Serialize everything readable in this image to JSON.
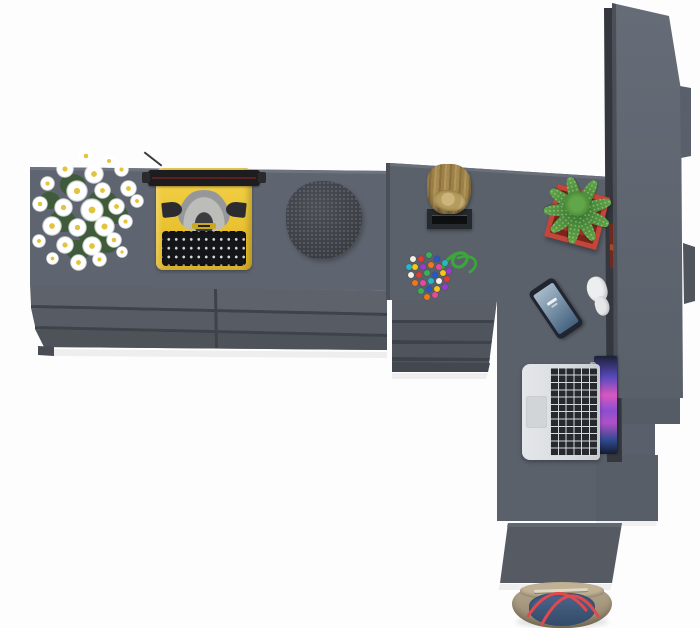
{
  "scene": {
    "type": "3d-render-top-view",
    "label": "Top-down view of a dark gray L-shaped desk with shelf unit and accessories on a white floor"
  },
  "palette": {
    "floor": "#fdfdfd",
    "desk_top": "#5f6570",
    "desk_top_edge": "#6e747f",
    "desk_surface": "#5a616b",
    "surface_edge": "#6a707b",
    "desk_front": "#51565d",
    "front_band_light": "#5e636b",
    "front_band_mid": "#575c64",
    "front_band_dark": "#4e535a",
    "seam": "#3e434a",
    "foot": "#484d54",
    "shelf_gap": "#34383e",
    "book_red": "#6f2b22",
    "book_orange": "#a84a28",
    "shelf_bump_light": "#5a606b",
    "shelf_bump_dark": "#4f545d",
    "step1": "#565c66",
    "step2": "#5a606b",
    "step3": "#585e68",
    "right_front": "#565b63",
    "right_front_edge": "#626871",
    "drawer_base": "#50555d",
    "drawer_band": "#5a5f67",
    "drawer_bottom": "#43484f",
    "column_edge": "#4b5058",
    "typewriter_yellow": "#ecc636",
    "typewriter_black": "#1d1d20",
    "typewriter_silver": "#bcbdb9",
    "pouf_gray": "#3e4147",
    "stump_wood": "#a0854a",
    "stand_black": "#26292d",
    "cactus_green": "#4d8d3b",
    "pot_red": "#ac3529",
    "phone_body": "#20252f",
    "earbud_white": "#eceef0",
    "laptop_silver": "#d9dcdf",
    "flower_center": "#e2c43e",
    "foliage_green": "#3c5a35",
    "cord_green": "#3aa838",
    "bead_colors": [
      "#e23b33",
      "#3bb054",
      "#2956c8",
      "#f5c518",
      "#9a3bd0",
      "#f07818",
      "#e64a9a",
      "#25b8c8",
      "#f4f0e8"
    ],
    "bag_beige": "#a89a81",
    "bag_denim": "#41597a",
    "bag_strap": "#e2494f"
  },
  "counts": {
    "flowers": 26,
    "foliage_blobs": 8,
    "beads": 27,
    "cactus_leaves": 9
  },
  "objects": [
    {
      "id": "sideboard",
      "label": "long sideboard desk with drawers"
    },
    {
      "id": "flower-bouquet",
      "label": "white daisy bouquet"
    },
    {
      "id": "typewriter",
      "label": "yellow vintage typewriter"
    },
    {
      "id": "pouf",
      "label": "dark knitted pouf"
    },
    {
      "id": "wood-stump",
      "label": "wooden stump on black wall stand"
    },
    {
      "id": "bead-necklace",
      "label": "colorful bead necklace with green cord"
    },
    {
      "id": "cactus-planter",
      "label": "cactus in red square planter"
    },
    {
      "id": "smartphone",
      "label": "smartphone"
    },
    {
      "id": "earphones",
      "label": "white earphones"
    },
    {
      "id": "laptop",
      "label": "open silver laptop with colorful wallpaper"
    },
    {
      "id": "wall-shelf",
      "label": "tall wall shelf unit"
    },
    {
      "id": "desk-return",
      "label": "desk return with drawer column"
    },
    {
      "id": "tote-bag",
      "label": "canvas tote bag with red straps"
    }
  ]
}
